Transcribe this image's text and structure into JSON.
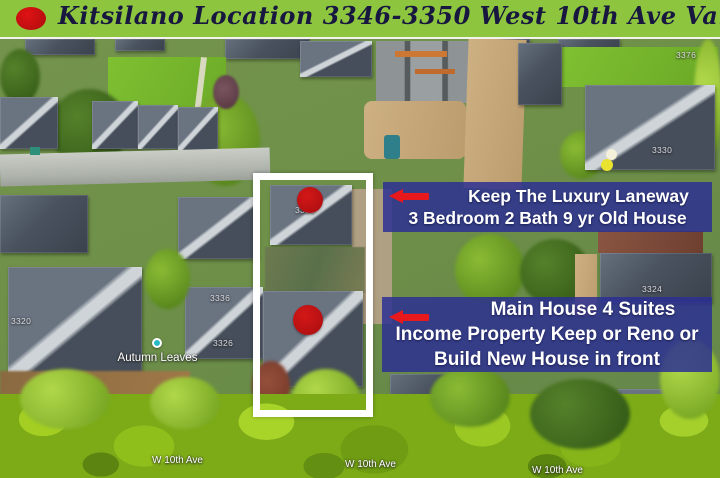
{
  "header": {
    "title": "Kitsilano Location 3346-3350 West 10th Ave Vancouver BC",
    "bg_color": "#8dc63e",
    "text_color": "#17173f",
    "bullet_color": "#c81113"
  },
  "annotations": {
    "box_bg_color": "#2e3192",
    "arrow_color": "#e8191c",
    "laneway_note": {
      "lines": [
        "Keep The Luxury Laneway",
        "3 Bedroom 2 Bath 9 yr Old House"
      ]
    },
    "main_house_note": {
      "lines": [
        "Main House 4 Suites",
        "Income Property Keep or Reno or",
        "Build New House in front"
      ]
    }
  },
  "map": {
    "highlight_border_color": "#ffffff",
    "marker_color": "#c31314",
    "street_labels": [
      "W 10th Ave",
      "W 10th Ave",
      "W 10th Ave"
    ],
    "place_label": "Autumn Leaves",
    "addresses": [
      "3350",
      "3336",
      "3326",
      "3320",
      "3330",
      "3324",
      "3376"
    ]
  }
}
